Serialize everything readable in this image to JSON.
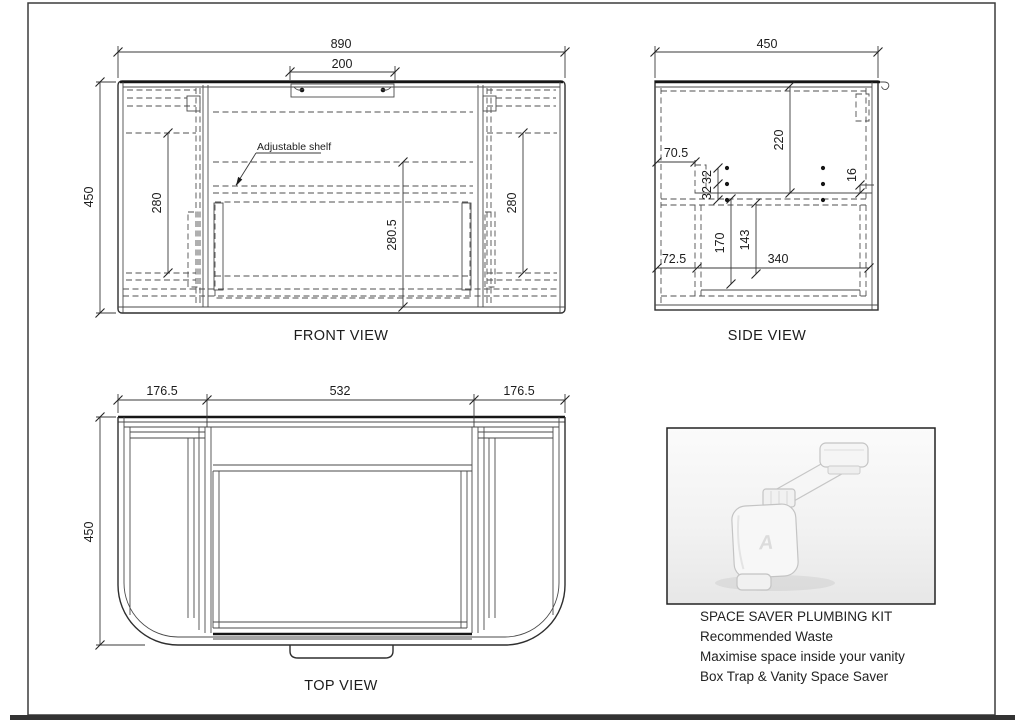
{
  "drawing": {
    "front": {
      "caption": "FRONT VIEW",
      "dim_overall_width": "890",
      "dim_handle_width": "200",
      "dim_overall_height": "450",
      "dim_left_door": "280",
      "dim_center_opening": "280.5",
      "dim_right_door": "280",
      "label_adjustable_shelf": "Adjustable shelf"
    },
    "side": {
      "caption": "SIDE VIEW",
      "dim_overall_depth": "450",
      "dim_top_section": "220",
      "dim_front_offset": "70.5",
      "dim_hole_pitch_a": "32",
      "dim_hole_pitch_b": "32",
      "dim_rail": "16",
      "dim_drawer_depth_a": "170",
      "dim_drawer_depth_b": "143",
      "dim_runner_length": "340",
      "dim_back_offset": "72.5"
    },
    "top": {
      "caption": "TOP VIEW",
      "dim_left_wing": "176.5",
      "dim_center": "532",
      "dim_right_wing": "176.5",
      "dim_depth": "450"
    }
  },
  "plumbing_kit": {
    "title": "SPACE SAVER PLUMBING KIT",
    "line1": "Recommended Waste",
    "line2": "Maximise space inside your vanity",
    "line3": "Box Trap & Vanity Space Saver",
    "watermark": "A"
  }
}
